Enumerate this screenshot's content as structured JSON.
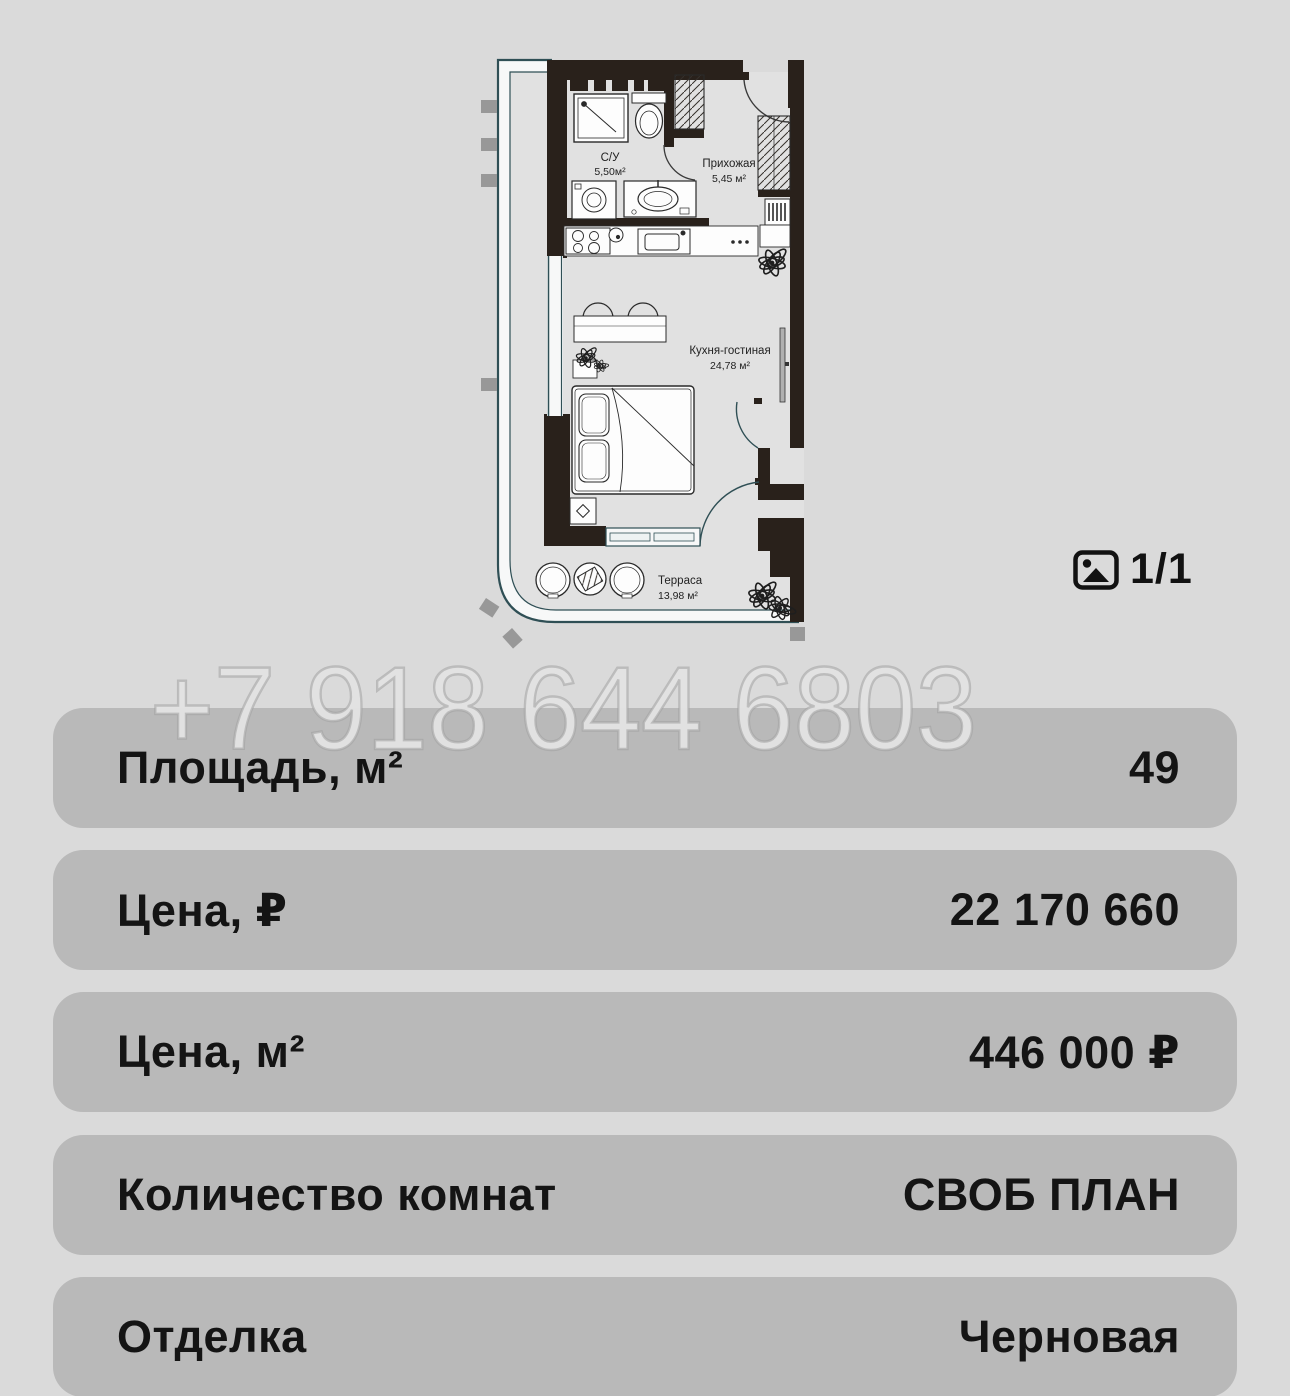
{
  "floorplan": {
    "rooms": [
      {
        "name": "С/У",
        "area": "5,50м²"
      },
      {
        "name": "Прихожая",
        "area": "5,45 м²"
      },
      {
        "name": "Кухня-гостиная",
        "area": "24,78 м²"
      },
      {
        "name": "Терраса",
        "area": "13,98 м²"
      }
    ]
  },
  "gallery": {
    "counter": "1/1"
  },
  "watermark": {
    "phone": "+7 918 644 6803"
  },
  "details": {
    "rows": [
      {
        "label": "Площадь, м²",
        "value": "49"
      },
      {
        "label": "Цена, ₽",
        "value": "22 170 660"
      },
      {
        "label": "Цена, м²",
        "value": "446 000 ₽"
      },
      {
        "label": "Количество комнат",
        "value": "СВОБ ПЛАН"
      },
      {
        "label": "Отделка",
        "value": "Черновая"
      }
    ]
  },
  "colors": {
    "page_bg": "#dadada",
    "card_bg": "#b9b9b9",
    "text": "#141414",
    "plan_wall": "#29211b",
    "plan_glass": "#2f4f55",
    "watermark": "#e2e2e2"
  }
}
